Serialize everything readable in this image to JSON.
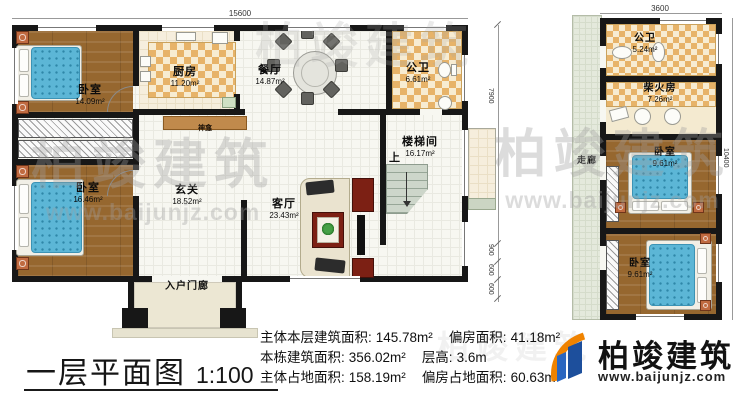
{
  "title": {
    "text": "一层平面图",
    "scale": "1:100"
  },
  "stats": {
    "rows": [
      {
        "l1": "主体本层建筑面积:",
        "v1": "145.78m²",
        "l2": "偏房面积:",
        "v2": "41.18m²"
      },
      {
        "l1": "本栋建筑面积:",
        "v1": "356.02m²",
        "l2": "层高:",
        "v2": "3.6m"
      },
      {
        "l1": "主体占地面积:",
        "v1": "158.19m²",
        "l2": "偏房占地面积:",
        "v2": "60.63m²"
      }
    ]
  },
  "brand": {
    "name": "柏竣建筑",
    "url": "www.baijunjz.com"
  },
  "watermark": {
    "name": "柏竣建筑",
    "url": "www.baijunjz.com"
  },
  "main_plan": {
    "dim_top": "15600",
    "dims_right": [
      "7900",
      "900",
      "600",
      "600"
    ],
    "rooms": {
      "bedroom1": {
        "name": "卧室",
        "area": "14.09m²"
      },
      "kitchen": {
        "name": "厨房",
        "area": "11.20m²"
      },
      "dining": {
        "name": "餐厅",
        "area": "14.87m²"
      },
      "bath": {
        "name": "公卫",
        "area": "6.61m²"
      },
      "stair": {
        "name": "楼梯间",
        "area": "16.17m²",
        "up": "上"
      },
      "bedroom2": {
        "name": "卧室",
        "area": "16.46m²"
      },
      "foyer": {
        "name": "玄关",
        "area": "18.52m²"
      },
      "living": {
        "name": "客厅",
        "area": "23.43m²"
      },
      "porch": {
        "name": "入户门廊"
      },
      "shrine": {
        "name": "神龛"
      }
    }
  },
  "side_plan": {
    "dim_top": "3600",
    "dim_right": "10400",
    "rooms": {
      "bath": {
        "name": "公卫",
        "area": "5.24m²"
      },
      "firewood": {
        "name": "柴火房",
        "area": "7.26m²"
      },
      "bedroom3": {
        "name": "卧室",
        "area": "9.61m²"
      },
      "bedroom4": {
        "name": "卧室",
        "area": "9.61m²"
      },
      "corridor": {
        "name": "走廊"
      }
    }
  },
  "colors": {
    "wall": "#171717",
    "wood_floor": "#96672f",
    "tile_checker": "#e7b369",
    "bed": "#5cb6d6",
    "brand_blue": "#1d4f9c",
    "brand_orange": "#f08300"
  }
}
